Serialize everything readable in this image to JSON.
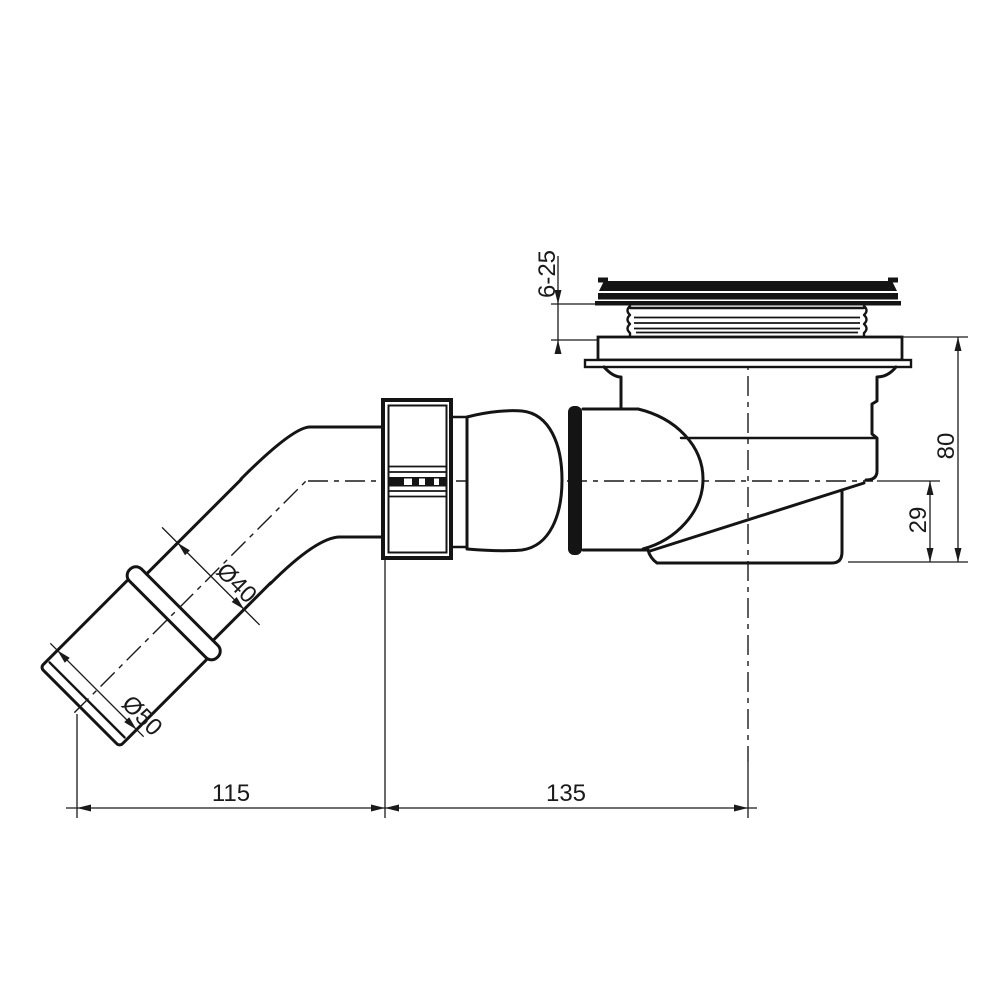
{
  "drawing": {
    "type": "technical-drawing",
    "subject": "shower-drain-trap-side-view",
    "colors": {
      "line": "#141414",
      "background": "#ffffff"
    },
    "dimensions": {
      "cap_adjust_range": "6-25",
      "total_height": "80",
      "outlet_center_height": "29",
      "outlet_pipe_diameter": "Ø40",
      "inlet_socket_diameter": "Ø50",
      "inlet_horizontal_offset": "115",
      "body_horizontal_offset": "135"
    }
  }
}
